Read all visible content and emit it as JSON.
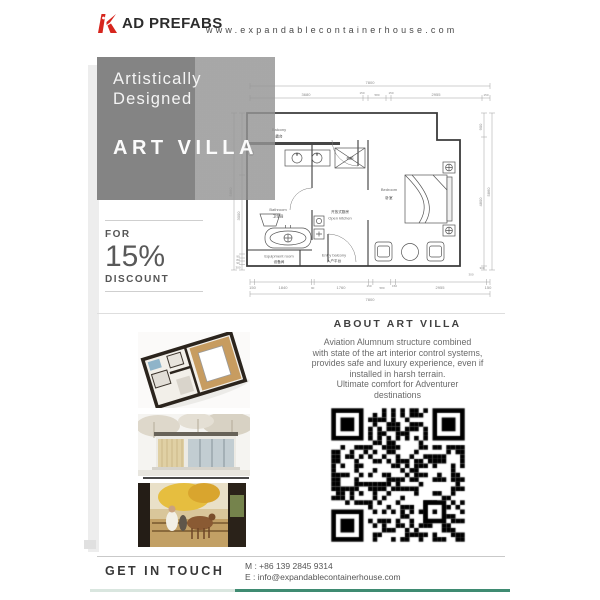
{
  "header": {
    "logo_text": "AD PREFABS",
    "website": "www.expandablecontainerhouse.com"
  },
  "hero": {
    "line1": "Artistically",
    "line2": "Designed",
    "title": "ART VILLA"
  },
  "offer": {
    "for_label": "FOR",
    "percent": "15%",
    "discount_label": "DISCOUNT"
  },
  "floorplan": {
    "dim_top_total": "7800",
    "dim_top": [
      "3680",
      "150",
      "580",
      "150",
      "2955",
      "150"
    ],
    "dim_bottom": [
      "150",
      "1840",
      "90",
      "1760",
      "150",
      "580",
      "150",
      "2955",
      "150"
    ],
    "dim_bottom_total": "7800",
    "dim_left_total": "5860",
    "dim_left": [
      "3000",
      "90",
      "80",
      "90",
      "300"
    ],
    "dim_right": [
      "900",
      "4800",
      "300"
    ],
    "dim_right_total": "5860",
    "labels": {
      "balcony_en": "Balcony",
      "balcony_cn": "露台",
      "bathroom_en": "Bathroom",
      "bathroom_cn": "卫生间",
      "kitchen_cn": "开放式厨房",
      "kitchen_en": "Open kitchen",
      "wardrobe_cn": "衣柜",
      "equipment_en": "Equipment room",
      "equipment_cn": "设备间",
      "entry_en": "Entry balcony",
      "entry_cn": "入户平台",
      "bedroom_en": "Bedroom",
      "bedroom_cn": "卧室"
    }
  },
  "about": {
    "title": "ABOUT ART VILLA",
    "lines": [
      "Aviation Alumnum structure combined",
      "with state of the art interior control systems,",
      "provides safe and luxury experience, even if",
      "installed in harsh terrain.",
      "Ultimate comfort for Adventurer",
      "destinations"
    ]
  },
  "contact": {
    "heading": "GET IN TOUCH",
    "mobile": "M : +86 139 2845 9314",
    "email": "E : info@expandablecontainerhouse.com"
  },
  "media": {
    "image1": "3d-floorplan-render",
    "image2": "container-house-exterior-render",
    "image3": "outdoor-lifestyle-photo"
  },
  "colors": {
    "logo_red": "#d6251d",
    "accent_green": "#3f8b72",
    "hero_gray": "#858585"
  }
}
